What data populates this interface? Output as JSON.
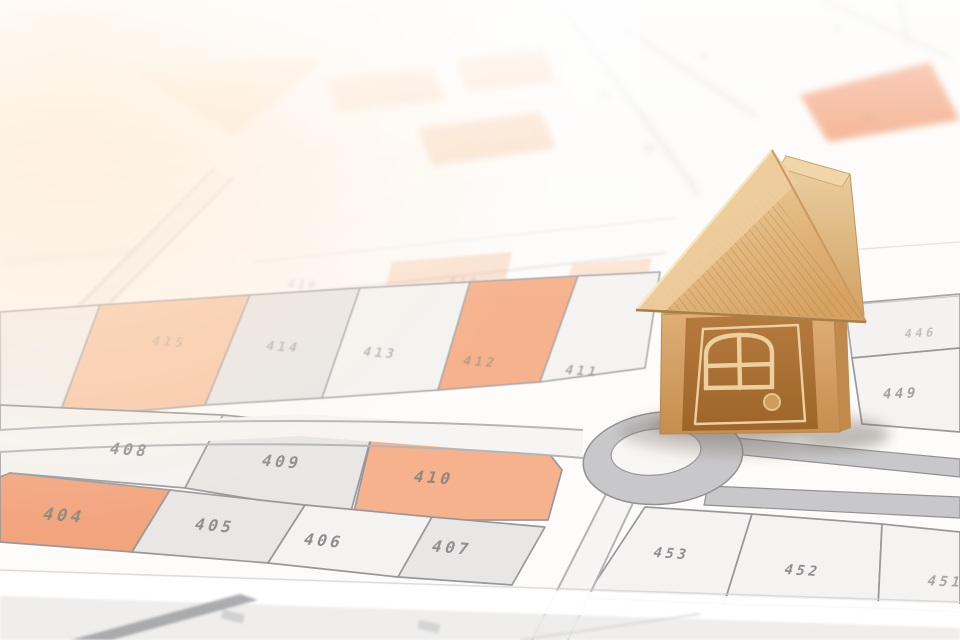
{
  "scene": {
    "subject": "wooden-house-model-on-cadastral-parcel-map",
    "map_type": "cadastral zoning plan"
  },
  "colors": {
    "paper": "#fdfcfa",
    "parcel_white": "#f4f3f1",
    "parcel_gray": "#e8e7e6",
    "parcel_orange": "#f2a47d",
    "parcel_orange_light": "#f6b28c",
    "parcel_orange_pale": "#f8c7a6",
    "road_gray": "#c8c8ca",
    "road_white": "#f6f5f3",
    "line_gray": "#98989b",
    "label_gray": "#8e8e90",
    "flare": "#ffdfb6",
    "wood_light": "#f0d6a8",
    "wood_mid": "#dfb077",
    "wood_dark": "#b0763c",
    "wood_engrave": "#ecd0a0",
    "shadow": "#7a7066"
  },
  "map": {
    "parcels": [
      {
        "label": "404",
        "fill": "orange"
      },
      {
        "label": "405",
        "fill": "gray"
      },
      {
        "label": "406",
        "fill": "white"
      },
      {
        "label": "407",
        "fill": "gray"
      },
      {
        "label": "408",
        "fill": "white"
      },
      {
        "label": "409",
        "fill": "gray"
      },
      {
        "label": "410",
        "fill": "orange"
      },
      {
        "label": "411",
        "fill": "white"
      },
      {
        "label": "412",
        "fill": "orange"
      },
      {
        "label": "413",
        "fill": "white"
      },
      {
        "label": "414",
        "fill": "gray"
      },
      {
        "label": "415",
        "fill": "orange"
      },
      {
        "label": "446",
        "fill": "white"
      },
      {
        "label": "449",
        "fill": "white"
      },
      {
        "label": "451",
        "fill": "white"
      },
      {
        "label": "452",
        "fill": "white"
      },
      {
        "label": "453",
        "fill": "white"
      }
    ],
    "ghost_labels": [
      "419",
      "418",
      "417"
    ]
  }
}
